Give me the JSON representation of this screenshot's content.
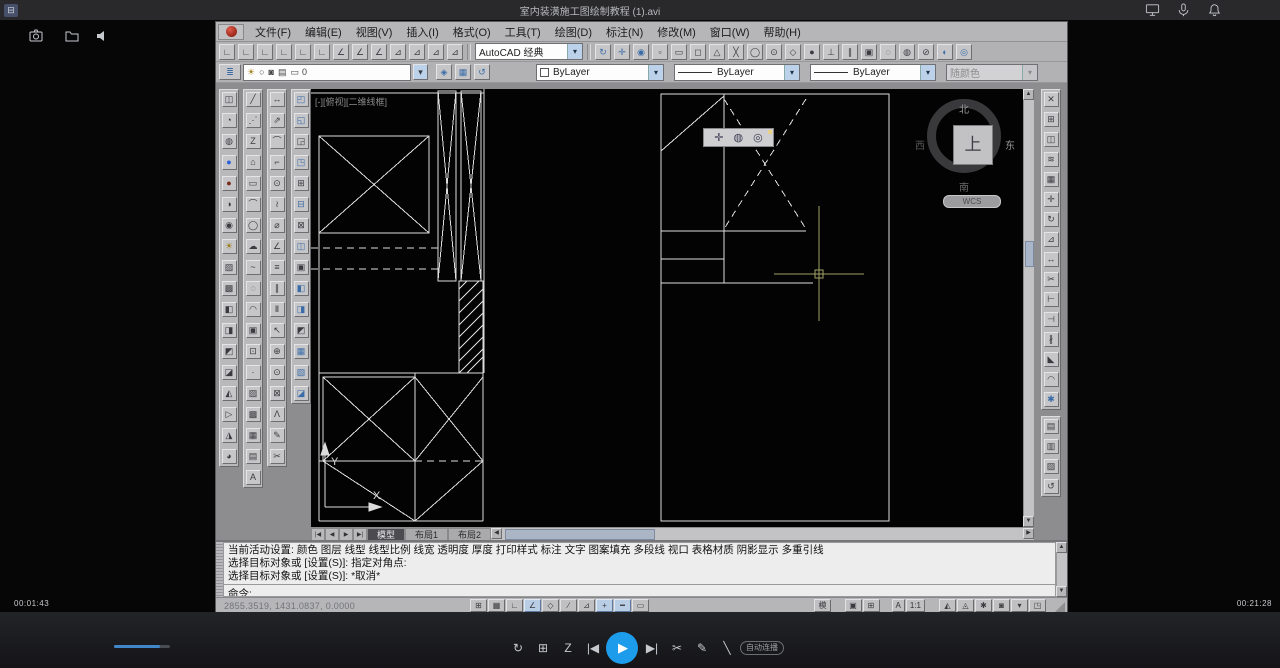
{
  "player": {
    "topbar": {
      "title": "室内装潢施工图绘制教程 (1).avi"
    },
    "bottom": {
      "time_current": "00:01:43",
      "time_total": "00:21:28",
      "autoplay_label": "自动连播",
      "center_left": [
        {
          "name": "replay-button",
          "glyph": "↻"
        },
        {
          "name": "episodes-button",
          "glyph": "⊞"
        },
        {
          "name": "speed-button",
          "glyph": "Z"
        },
        {
          "name": "prev-button",
          "glyph": "|◀"
        }
      ],
      "center_right": [
        {
          "name": "next-button",
          "glyph": "▶|"
        },
        {
          "name": "clip-button",
          "glyph": "✂"
        },
        {
          "name": "note-button",
          "glyph": "✎"
        },
        {
          "name": "marker-button",
          "glyph": "╲"
        }
      ]
    }
  },
  "cad": {
    "menus": [
      {
        "name": "menu-file",
        "label": "文件(F)"
      },
      {
        "name": "menu-edit",
        "label": "编辑(E)"
      },
      {
        "name": "menu-view",
        "label": "视图(V)"
      },
      {
        "name": "menu-insert",
        "label": "插入(I)"
      },
      {
        "name": "menu-format",
        "label": "格式(O)"
      },
      {
        "name": "menu-tools",
        "label": "工具(T)"
      },
      {
        "name": "menu-draw",
        "label": "绘图(D)"
      },
      {
        "name": "menu-dimension",
        "label": "标注(N)"
      },
      {
        "name": "menu-modify",
        "label": "修改(M)"
      },
      {
        "name": "menu-window",
        "label": "窗口(W)"
      },
      {
        "name": "menu-help",
        "label": "帮助(H)"
      }
    ],
    "standard": {
      "workspace": "AutoCAD 经典"
    },
    "properties": {
      "layer_name": "0",
      "color": "ByLayer",
      "linetype": "ByLayer",
      "lineweight": "ByLayer",
      "plot_style": "随颜色"
    },
    "canvas": {
      "viewport_label": "[-][俯视][二维线框]",
      "ucs_x": "X",
      "ucs_y": "Y",
      "viewcube": {
        "face": "上",
        "n": "北",
        "e": "东",
        "s": "南",
        "w": "西",
        "wcs": "WCS"
      }
    },
    "tabs": {
      "nav": [
        {
          "name": "tab-first-button",
          "glyph": "|◀"
        },
        {
          "name": "tab-prev-button",
          "glyph": "◀"
        },
        {
          "name": "tab-next-button",
          "glyph": "▶"
        },
        {
          "name": "tab-last-button",
          "glyph": "▶|"
        }
      ],
      "items": [
        {
          "name": "tab-model",
          "label": "模型",
          "active": true
        },
        {
          "name": "tab-layout1",
          "label": "布局1"
        },
        {
          "name": "tab-layout2",
          "label": "布局2"
        }
      ]
    },
    "command": {
      "lines": [
        "当前活动设置: 颜色 图层 线型 线型比例 线宽 透明度 厚度 打印样式 标注 文字 图案填充 多段线 视口 表格材质 阴影显示 多重引线",
        "选择目标对象或 [设置(S)]: 指定对角点:",
        "选择目标对象或 [设置(S)]: *取消*"
      ],
      "prompt": "命令:"
    },
    "statusbar": {
      "coords": "2855.3519, 1431.0837, 0.0000",
      "model_label": "模型",
      "annotation_label": "A",
      "scale_label": "1:1",
      "toggles": [
        {
          "name": "snap-toggle",
          "glyph": "⊞"
        },
        {
          "name": "grid-toggle",
          "glyph": "▦"
        },
        {
          "name": "ortho-toggle",
          "glyph": "∟"
        },
        {
          "name": "polar-toggle",
          "glyph": "∠",
          "active": true
        },
        {
          "name": "osnap-toggle",
          "glyph": "◇"
        },
        {
          "name": "otrack-toggle",
          "glyph": "∕"
        },
        {
          "name": "ducs-toggle",
          "glyph": "⊿"
        },
        {
          "name": "dyn-toggle",
          "glyph": "+",
          "active": true
        },
        {
          "name": "lwt-toggle",
          "glyph": "━",
          "active": true
        },
        {
          "name": "qp-toggle",
          "glyph": "▭"
        }
      ],
      "right1": [
        {
          "name": "quick-view-layouts-button",
          "glyph": "▣"
        },
        {
          "name": "quick-view-drawings-button",
          "glyph": "⊞"
        }
      ],
      "right2": [
        {
          "name": "annotation-visibility-button",
          "glyph": "◭"
        },
        {
          "name": "annotation-autoscale-button",
          "glyph": "◬"
        },
        {
          "name": "workspace-switch-button",
          "glyph": "✱"
        },
        {
          "name": "toolbar-lock-button",
          "glyph": "◙"
        },
        {
          "name": "status-menu-button",
          "glyph": "▾"
        },
        {
          "name": "cleanscreen-button",
          "glyph": "◳"
        }
      ]
    },
    "icons": {
      "std_left": [
        {
          "name": "ucs-icon",
          "glyph": "∟"
        },
        {
          "name": "ucs-world-icon",
          "glyph": "∟"
        },
        {
          "name": "ucs-previous-icon",
          "glyph": "∟"
        },
        {
          "name": "ucs-face-icon",
          "glyph": "∟"
        },
        {
          "name": "ucs-object-icon",
          "glyph": "∟"
        },
        {
          "name": "ucs-view-icon",
          "glyph": "∟"
        },
        {
          "name": "ucs-origin-icon",
          "glyph": "∠"
        },
        {
          "name": "ucs-zaxis-icon",
          "glyph": "∠"
        },
        {
          "name": "ucs-3point-icon",
          "glyph": "∠"
        },
        {
          "name": "ucs-x-icon",
          "glyph": "⊿"
        },
        {
          "name": "ucs-y-icon",
          "glyph": "⊿"
        },
        {
          "name": "ucs-z-icon",
          "glyph": "⊿"
        },
        {
          "name": "ucs-named-icon",
          "glyph": "⊿"
        }
      ],
      "std_right": [
        {
          "name": "redo-icon",
          "glyph": "↻",
          "color": "#3b6ca8"
        },
        {
          "name": "pan-icon",
          "glyph": "✛",
          "color": "#3b6ca8"
        },
        {
          "name": "zoom-realtime-icon",
          "glyph": "◉",
          "color": "#3b6ca8"
        },
        {
          "name": "osnap-temporary-icon",
          "glyph": "▫"
        },
        {
          "name": "osnap-from-icon",
          "glyph": "▭"
        },
        {
          "name": "osnap-endpoint-icon",
          "glyph": "◻"
        },
        {
          "name": "osnap-midpoint-icon",
          "glyph": "△"
        },
        {
          "name": "osnap-intersection-icon",
          "glyph": "╳"
        },
        {
          "name": "osnap-extension-icon",
          "glyph": "◯"
        },
        {
          "name": "osnap-center-icon",
          "glyph": "⊙"
        },
        {
          "name": "osnap-quadrant-icon",
          "glyph": "◇"
        },
        {
          "name": "osnap-tangent-icon",
          "glyph": "●"
        },
        {
          "name": "osnap-perpendicular-icon",
          "glyph": "⊥"
        },
        {
          "name": "osnap-parallel-icon",
          "glyph": "∥"
        },
        {
          "name": "osnap-insert-icon",
          "glyph": "▣"
        },
        {
          "name": "osnap-node-icon",
          "glyph": "◌"
        },
        {
          "name": "osnap-nearest-icon",
          "glyph": "◍"
        },
        {
          "name": "osnap-none-icon",
          "glyph": "⊘"
        },
        {
          "name": "osnap-settings-icon",
          "glyph": "◐",
          "color": "#3b6ca8"
        },
        {
          "name": "orbit-icon",
          "glyph": "◎",
          "color": "#3b6ca8"
        }
      ],
      "layer_props": [
        {
          "name": "layer-properties-icon",
          "glyph": "≣",
          "color": "#3b6ca8"
        }
      ],
      "layer_field": [
        {
          "name": "layer-visibility-icon",
          "glyph": "☀",
          "color": "#a07d18"
        },
        {
          "name": "layer-freeze-icon",
          "glyph": "○"
        },
        {
          "name": "layer-lock-icon",
          "glyph": "◙"
        },
        {
          "name": "layer-plot-icon",
          "glyph": "▤"
        },
        {
          "name": "layer-vpfreeze-icon",
          "glyph": "▭"
        }
      ],
      "layer_tools": [
        {
          "name": "make-object-layer-current-icon",
          "glyph": "◈",
          "color": "#3b6ca8"
        },
        {
          "name": "layer-states-icon",
          "glyph": "▦",
          "color": "#3b6ca8"
        },
        {
          "name": "layer-previous-icon",
          "glyph": "↺",
          "color": "#3b6ca8"
        }
      ],
      "palette1": [
        {
          "name": "named-views-icon",
          "glyph": "◫"
        },
        {
          "name": "orbit-3d-icon",
          "glyph": "◔"
        },
        {
          "name": "render-icon",
          "glyph": "◍"
        },
        {
          "name": "sphere-blue-icon",
          "glyph": "●",
          "color": "#2b5fd9"
        },
        {
          "name": "sphere-red-icon",
          "glyph": "●",
          "color": "#7a2a1a"
        },
        {
          "name": "shade-icon",
          "glyph": "◑"
        },
        {
          "name": "camera-icon",
          "glyph": "◉"
        },
        {
          "name": "light-icon",
          "glyph": "☀",
          "color": "#9a7a10"
        },
        {
          "name": "materials-icon",
          "glyph": "▨"
        },
        {
          "name": "mapping-icon",
          "glyph": "▩"
        },
        {
          "name": "section-plane-icon",
          "glyph": "◧"
        },
        {
          "name": "section-icon",
          "glyph": "◨"
        },
        {
          "name": "slice-icon",
          "glyph": "◩"
        },
        {
          "name": "walk-icon",
          "glyph": "◪"
        },
        {
          "name": "fly-icon",
          "glyph": "◭"
        },
        {
          "name": "animation-icon",
          "glyph": "▷"
        },
        {
          "name": "motion-path-icon",
          "glyph": "◮"
        },
        {
          "name": "zoom-window-icon",
          "glyph": "◕"
        }
      ],
      "palette2": [
        {
          "name": "line-icon",
          "glyph": "╱"
        },
        {
          "name": "construction-line-icon",
          "glyph": "⋰"
        },
        {
          "name": "polyline-icon",
          "glyph": "Z"
        },
        {
          "name": "polygon-icon",
          "glyph": "⌂"
        },
        {
          "name": "rectangle-icon",
          "glyph": "▭"
        },
        {
          "name": "arc-icon",
          "glyph": "⌒"
        },
        {
          "name": "circle-icon",
          "glyph": "◯"
        },
        {
          "name": "revcloud-icon",
          "glyph": "☁"
        },
        {
          "name": "spline-icon",
          "glyph": "~"
        },
        {
          "name": "ellipse-icon",
          "glyph": "◌"
        },
        {
          "name": "ellipse-arc-icon",
          "glyph": "◠"
        },
        {
          "name": "insert-block-icon",
          "glyph": "▣"
        },
        {
          "name": "make-block-icon",
          "glyph": "⊡"
        },
        {
          "name": "point-icon",
          "glyph": "·"
        },
        {
          "name": "hatch-icon",
          "glyph": "▨"
        },
        {
          "name": "gradient-icon",
          "glyph": "▩"
        },
        {
          "name": "region-icon",
          "glyph": "▦"
        },
        {
          "name": "table-icon",
          "glyph": "▤"
        },
        {
          "name": "mtext-icon",
          "glyph": "A"
        }
      ],
      "palette3": [
        {
          "name": "linear-dim-icon",
          "glyph": "↔"
        },
        {
          "name": "aligned-dim-icon",
          "glyph": "⇗"
        },
        {
          "name": "arc-length-icon",
          "glyph": "⌒"
        },
        {
          "name": "ordinate-dim-icon",
          "glyph": "⌐"
        },
        {
          "name": "radius-dim-icon",
          "glyph": "⊙"
        },
        {
          "name": "jogged-dim-icon",
          "glyph": "≀"
        },
        {
          "name": "diameter-dim-icon",
          "glyph": "⌀"
        },
        {
          "name": "angular-dim-icon",
          "glyph": "∠"
        },
        {
          "name": "quick-dim-icon",
          "glyph": "≡"
        },
        {
          "name": "baseline-dim-icon",
          "glyph": "∥"
        },
        {
          "name": "continue-dim-icon",
          "glyph": "Ⅱ"
        },
        {
          "name": "leader-icon",
          "glyph": "↖"
        },
        {
          "name": "tolerance-icon",
          "glyph": "⊕"
        },
        {
          "name": "center-mark-icon",
          "glyph": "⊙"
        },
        {
          "name": "inspection-icon",
          "glyph": "⊠"
        },
        {
          "name": "jog-line-icon",
          "glyph": "Λ"
        },
        {
          "name": "dim-edit-icon",
          "glyph": "✎"
        },
        {
          "name": "dim-style-icon",
          "glyph": "✂"
        }
      ],
      "palette4": [
        {
          "name": "tool-icon",
          "glyph": "◰",
          "color": "#3b6ca8"
        },
        {
          "name": "tool-icon",
          "glyph": "◱",
          "color": "#3b6ca8"
        },
        {
          "name": "tool-icon",
          "glyph": "◲"
        },
        {
          "name": "tool-icon",
          "glyph": "◳",
          "color": "#3b6ca8"
        },
        {
          "name": "tool-icon",
          "glyph": "⊞"
        },
        {
          "name": "tool-icon",
          "glyph": "⊟",
          "color": "#3b6ca8"
        },
        {
          "name": "tool-icon",
          "glyph": "⊠"
        },
        {
          "name": "tool-icon",
          "glyph": "◫",
          "color": "#3b6ca8"
        },
        {
          "name": "tool-icon",
          "glyph": "▣"
        },
        {
          "name": "tool-icon",
          "glyph": "◧",
          "color": "#3b6ca8"
        },
        {
          "name": "tool-icon",
          "glyph": "◨",
          "color": "#3b6ca8"
        },
        {
          "name": "tool-icon",
          "glyph": "◩"
        },
        {
          "name": "tool-icon",
          "glyph": "▦",
          "color": "#3b6ca8"
        },
        {
          "name": "tool-icon",
          "glyph": "▧",
          "color": "#3b6ca8"
        },
        {
          "name": "tool-icon",
          "glyph": "◪",
          "color": "#3b6ca8"
        }
      ],
      "modify_right": [
        {
          "name": "erase-icon",
          "glyph": "✕"
        },
        {
          "name": "copy-icon",
          "glyph": "⊞"
        },
        {
          "name": "mirror-icon",
          "glyph": "◫"
        },
        {
          "name": "offset-icon",
          "glyph": "≋"
        },
        {
          "name": "array-icon",
          "glyph": "▦"
        },
        {
          "name": "move-icon",
          "glyph": "✛"
        },
        {
          "name": "rotate-icon",
          "glyph": "↻"
        },
        {
          "name": "scale-icon",
          "glyph": "⊿"
        },
        {
          "name": "stretch-icon",
          "glyph": "↔"
        },
        {
          "name": "trim-icon",
          "glyph": "✂"
        },
        {
          "name": "extend-icon",
          "glyph": "⊢"
        },
        {
          "name": "break-at-point-icon",
          "glyph": "⊣"
        },
        {
          "name": "break-icon",
          "glyph": "∦"
        },
        {
          "name": "chamfer-icon",
          "glyph": "◣"
        },
        {
          "name": "fillet-icon",
          "glyph": "◠"
        },
        {
          "name": "explode-icon",
          "glyph": "✱",
          "color": "#3b6ca8"
        }
      ],
      "modify_right2": [
        {
          "name": "array-tool-icon",
          "glyph": "▤"
        },
        {
          "name": "copy-nested-icon",
          "glyph": "▥"
        },
        {
          "name": "hatch-edit-icon",
          "glyph": "▨"
        },
        {
          "name": "undo-tool-icon",
          "glyph": "↺"
        }
      ],
      "navbar": [
        {
          "name": "steering-wheel-icon",
          "glyph": "✛"
        },
        {
          "name": "pan-hand-icon",
          "glyph": "◍"
        },
        {
          "name": "orbit-icon",
          "glyph": "◎"
        }
      ]
    }
  }
}
